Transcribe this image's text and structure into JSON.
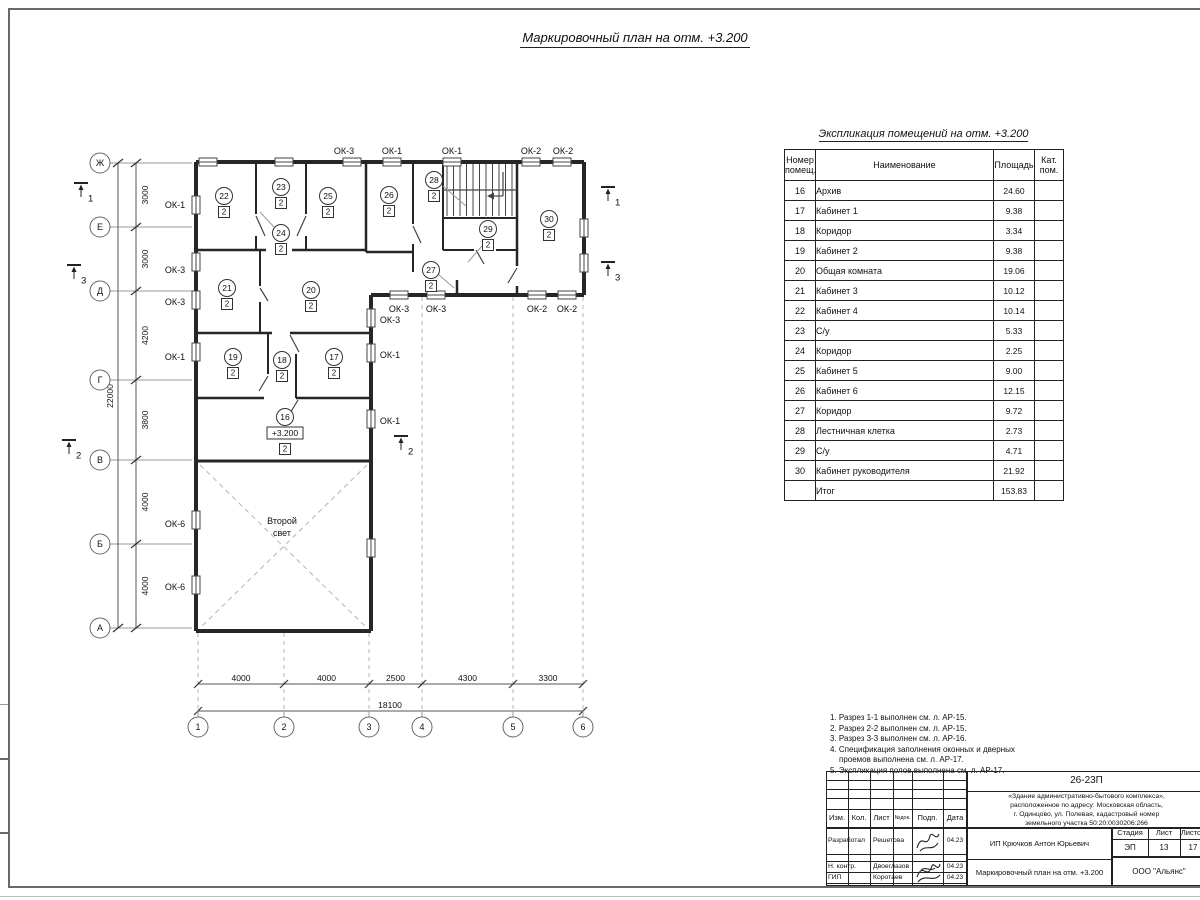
{
  "plan": {
    "title": "Маркировочный план на отм. +3.200",
    "row_axes": [
      "Ж",
      "Е",
      "Д",
      "Г",
      "В",
      "Б",
      "А"
    ],
    "col_axes": [
      "1",
      "2",
      "3",
      "4",
      "5",
      "6"
    ],
    "row_dims": [
      "3000",
      "3000",
      "4200",
      "3800",
      "4000",
      "4000"
    ],
    "row_total_dim": "22000",
    "col_dims": [
      "4000",
      "4000",
      "2500",
      "4300",
      "3300"
    ],
    "col_total_dim": "18100",
    "second_light_lines": [
      "Второй",
      "свет"
    ],
    "rooms": [
      {
        "num": "22",
        "cat": "2",
        "x": 224,
        "y": 196
      },
      {
        "num": "23",
        "cat": "2",
        "x": 281,
        "y": 187
      },
      {
        "num": "24",
        "cat": "2",
        "x": 281,
        "y": 233
      },
      {
        "num": "25",
        "cat": "2",
        "x": 328,
        "y": 196
      },
      {
        "num": "26",
        "cat": "2",
        "x": 389,
        "y": 195
      },
      {
        "num": "28",
        "cat": "2",
        "x": 434,
        "y": 180
      },
      {
        "num": "29",
        "cat": "2",
        "x": 488,
        "y": 229
      },
      {
        "num": "30",
        "cat": "2",
        "x": 549,
        "y": 219
      },
      {
        "num": "21",
        "cat": "2",
        "x": 227,
        "y": 288
      },
      {
        "num": "20",
        "cat": "2",
        "x": 311,
        "y": 290
      },
      {
        "num": "27",
        "cat": "2",
        "x": 431,
        "y": 270
      },
      {
        "num": "19",
        "cat": "2",
        "x": 233,
        "y": 357
      },
      {
        "num": "18",
        "cat": "2",
        "x": 282,
        "y": 360
      },
      {
        "num": "17",
        "cat": "2",
        "x": 334,
        "y": 357
      },
      {
        "num": "16",
        "cat": "2",
        "x": 285,
        "y": 417,
        "elev": "+3.200"
      }
    ],
    "window_labels": [
      {
        "t": "ОК-3",
        "x": 344,
        "y": 151
      },
      {
        "t": "ОК-1",
        "x": 392,
        "y": 151
      },
      {
        "t": "ОК-1",
        "x": 452,
        "y": 151
      },
      {
        "t": "ОК-2",
        "x": 531,
        "y": 151
      },
      {
        "t": "ОК-2",
        "x": 563,
        "y": 151
      },
      {
        "t": "ОК-1",
        "x": 175,
        "y": 205
      },
      {
        "t": "ОК-3",
        "x": 175,
        "y": 270
      },
      {
        "t": "ОК-3",
        "x": 175,
        "y": 302
      },
      {
        "t": "ОК-1",
        "x": 175,
        "y": 357
      },
      {
        "t": "ОК-6",
        "x": 175,
        "y": 524
      },
      {
        "t": "ОК-6",
        "x": 175,
        "y": 587
      },
      {
        "t": "ОК-3",
        "x": 399,
        "y": 309
      },
      {
        "t": "ОК-3",
        "x": 436,
        "y": 309
      },
      {
        "t": "ОК-2",
        "x": 537,
        "y": 309
      },
      {
        "t": "ОК-2",
        "x": 567,
        "y": 309
      },
      {
        "t": "ОК-3",
        "x": 390,
        "y": 320
      },
      {
        "t": "ОК-1",
        "x": 390,
        "y": 355
      },
      {
        "t": "ОК-1",
        "x": 390,
        "y": 421
      }
    ],
    "sections": [
      {
        "n": "1",
        "x": 81,
        "y": 183
      },
      {
        "n": "3",
        "x": 74,
        "y": 265
      },
      {
        "n": "2",
        "x": 69,
        "y": 440
      },
      {
        "n": "2",
        "x": 401,
        "y": 436
      },
      {
        "n": "1",
        "x": 608,
        "y": 187
      },
      {
        "n": "3",
        "x": 608,
        "y": 262
      }
    ]
  },
  "explication": {
    "title": "Экспликация помещений на отм. +3.200",
    "headers": {
      "num": "Номер помещ.",
      "name": "Наименование",
      "area": "Площадь",
      "cat": "Кат. пом."
    },
    "rows": [
      [
        "16",
        "Архив",
        "24.60",
        ""
      ],
      [
        "17",
        "Кабинет 1",
        "9.38",
        ""
      ],
      [
        "18",
        "Коридор",
        "3.34",
        ""
      ],
      [
        "19",
        "Кабинет 2",
        "9.38",
        ""
      ],
      [
        "20",
        "Общая комната",
        "19.06",
        ""
      ],
      [
        "21",
        "Кабинет 3",
        "10.12",
        ""
      ],
      [
        "22",
        "Кабинет 4",
        "10.14",
        ""
      ],
      [
        "23",
        "С/у",
        "5.33",
        ""
      ],
      [
        "24",
        "Коридор",
        "2.25",
        ""
      ],
      [
        "25",
        "Кабинет 5",
        "9.00",
        ""
      ],
      [
        "26",
        "Кабинет 6",
        "12.15",
        ""
      ],
      [
        "27",
        "Коридор",
        "9.72",
        ""
      ],
      [
        "28",
        "Лестничная клетка",
        "2.73",
        ""
      ],
      [
        "29",
        "С/у",
        "4.71",
        ""
      ],
      [
        "30",
        "Кабинет руководителя",
        "21.92",
        ""
      ],
      [
        "",
        "Итог",
        "153.83",
        ""
      ]
    ]
  },
  "notes_lines": [
    "1. Разрез 1-1 выполнен см. л. АР-15.",
    "2. Разрез 2-2 выполнен см. л. АР-15.",
    "3. Разрез 3-3 выполнен см. л. АР-16.",
    "4. Спецификация заполнения оконных и дверных",
    "проемов выполнена см. л. АР-17.",
    "5. Экспликация полов выполнена см. л. АР-17."
  ],
  "titleblock": {
    "code": "26-23П",
    "description_lines": [
      "«Здание административно-бытового комплекса»,",
      "расположенное по адресу: Московская область,",
      "г. Одинцово, ул. Полевая, кадастровый номер",
      "земельного участка 50:20:0030206:266"
    ],
    "header_cells": {
      "izm": "Изм.",
      "kol": "Кол.",
      "list": "Лист",
      "ndok": "№док.",
      "podp": "Подп.",
      "data": "Дата"
    },
    "sign_rows": [
      {
        "role": "Разработал",
        "name": "Решетова",
        "date": "04.23"
      },
      {
        "role": "Н. контр.",
        "name": "Двоеглазов",
        "date": "04.23"
      },
      {
        "role": "ГИП",
        "name": "Коротаев",
        "date": "04.23"
      }
    ],
    "client": "ИП Крючков Антон Юрьевич",
    "doc_title": "Маркировочный план на отм. +3.200",
    "stage_header": "Стадия",
    "sheet_header": "Лист",
    "sheets_header": "Листов",
    "stage": "ЭП",
    "sheet": "13",
    "sheets": "17",
    "company": "ООО \"Альянс\""
  },
  "colors": {
    "wall": "#262626",
    "thin": "#444444",
    "light": "#999999",
    "dashed": "#b5b5b5",
    "text": "#111111"
  }
}
